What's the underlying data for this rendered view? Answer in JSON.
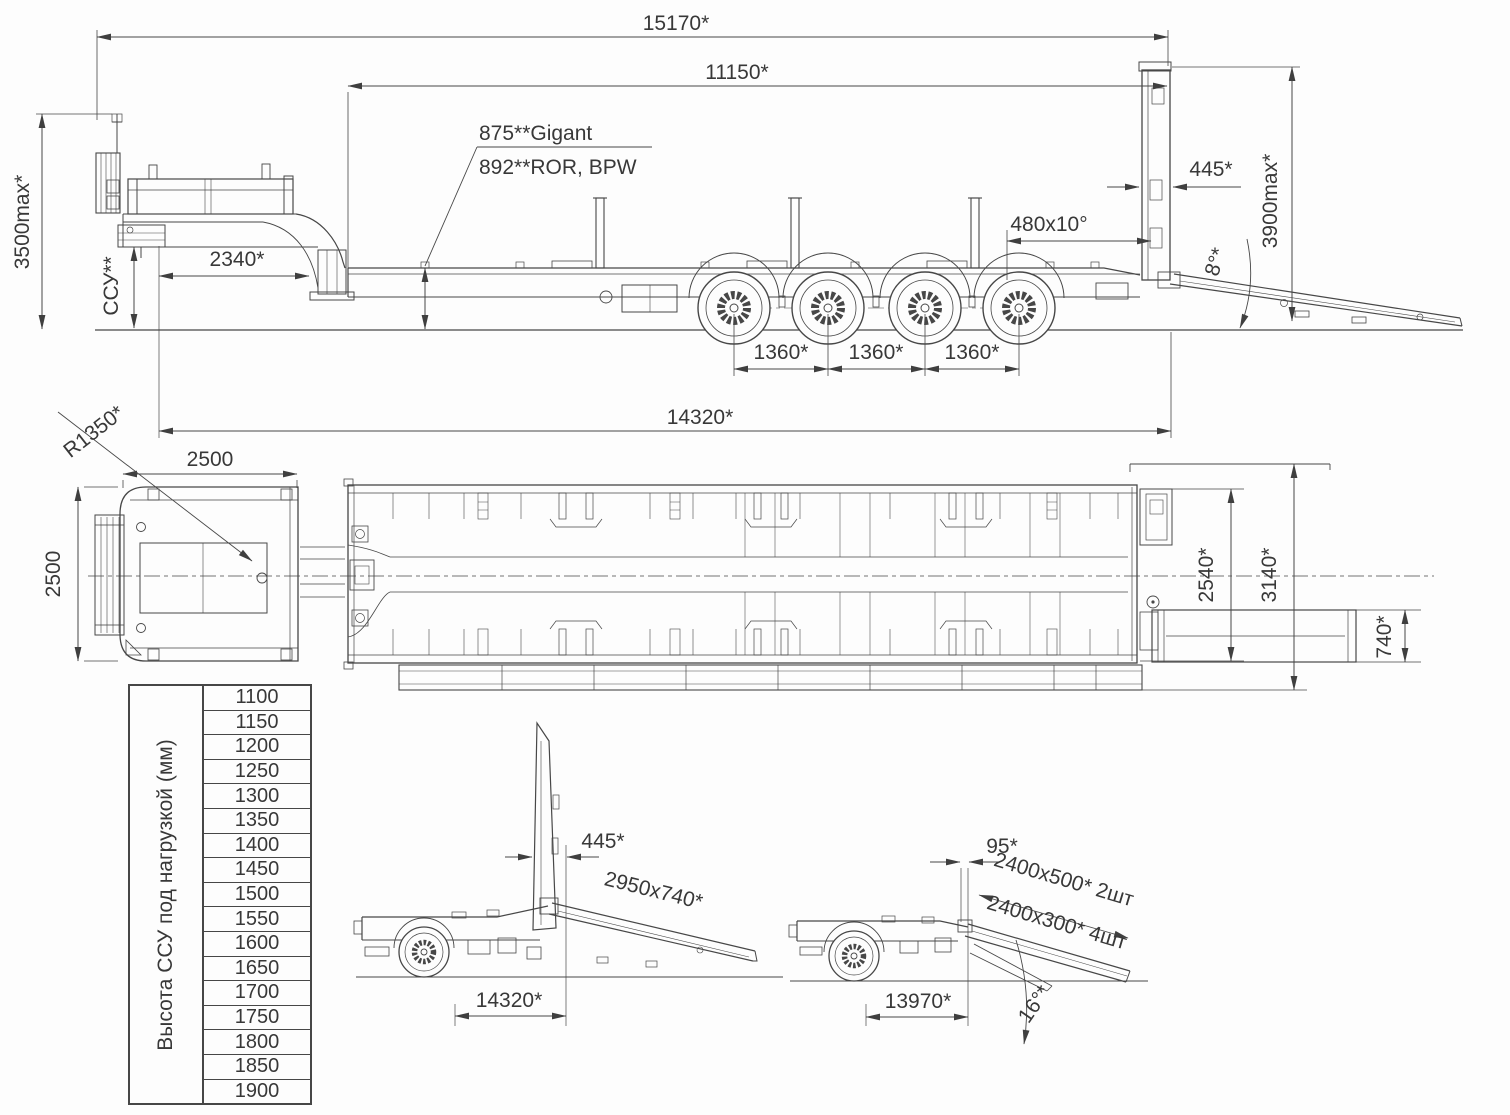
{
  "colors": {
    "line": "#474747",
    "text": "#383838",
    "bg": "#fdfdfd"
  },
  "side": {
    "overall_length": "15170*",
    "deck_length": "11150*",
    "deck_height_gigant": "875**Gigant",
    "deck_height_ror_bpw": "892**ROR, BPW",
    "rear_flap": "445*",
    "beavertail": "480x10°",
    "max_ramp_height": "3900max*",
    "ramp_angle": "8°*",
    "kingpin_to_gooseneck": "2340*",
    "fifth_wheel": "ССУ**",
    "max_height": "3500max*",
    "axle_spacing": "1360*",
    "kingpin_to_rear": "14320*"
  },
  "plan": {
    "corner_radius": "R1350*",
    "gooseneck_width": "2500",
    "gooseneck_length": "2500",
    "deck_width": "2540*",
    "overall_width": "3140*",
    "ramp_width": "740*"
  },
  "flap": {
    "flap_width": "445*",
    "ramp_size": "2950x740*",
    "kingpin_to_rear": "14320*"
  },
  "angle": {
    "flap_offset": "95*",
    "ramps_upper": "2400x500* 2шт",
    "ramps_lower": "2400x300* 4шт",
    "kingpin_to_ramp": "13970*",
    "ramp_angle": "16°*"
  },
  "table": {
    "header": "Высота ССУ под нагрузкой (мм)",
    "values": [
      "1100",
      "1150",
      "1200",
      "1250",
      "1300",
      "1350",
      "1400",
      "1450",
      "1500",
      "1550",
      "1600",
      "1650",
      "1700",
      "1750",
      "1800",
      "1850",
      "1900"
    ]
  }
}
